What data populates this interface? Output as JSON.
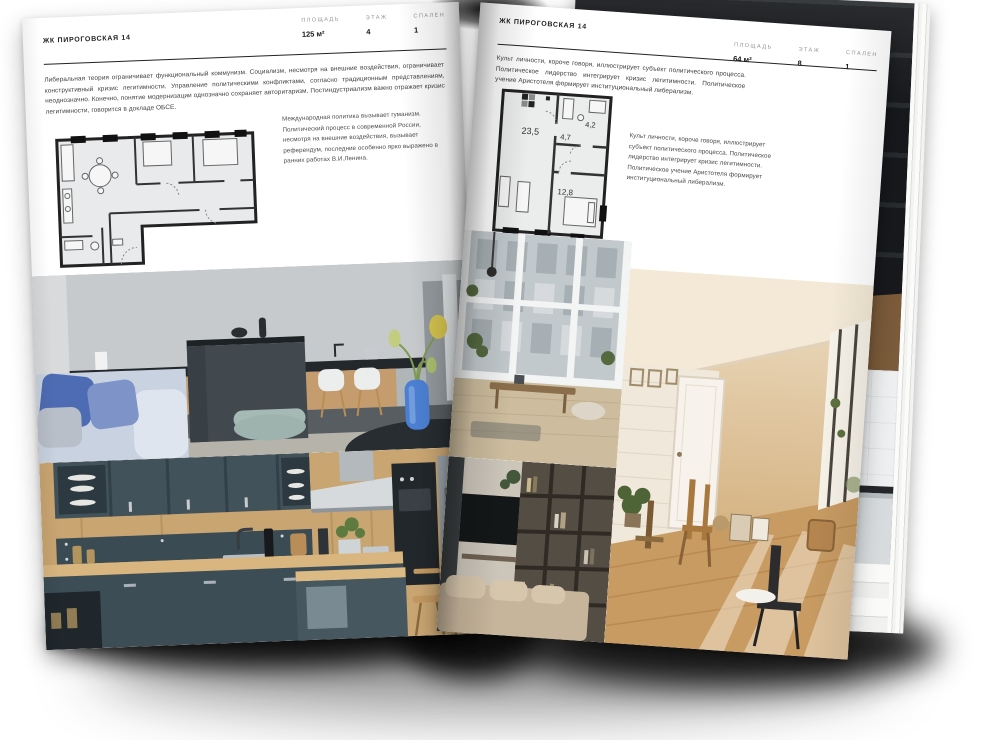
{
  "book": {
    "left_page": {
      "header": "ЖК ПИРОГОВСКАЯ 14",
      "stats": [
        {
          "label": "ПЛОЩАДЬ",
          "value": "125 м²"
        },
        {
          "label": "ЭТАЖ",
          "value": "4"
        },
        {
          "label": "СПАЛЕН",
          "value": "1"
        }
      ],
      "paragraph": "Либеральная теория ограничивает функциональный коммунизм. Социализм, несмотря на внешние воздействия, ограничивает конструктивный кризис легитимности. Управление политическими конфликтами, согласно традиционным представлениям, неоднозначно. Конечно, понятие модернизации однозначно сохраняет авторитаризм. Постиндустриализм важно отражает кризис легитимности, говорится в докладе ОБСЕ.",
      "caption": "Международная политика вызывает гуманизм. Политический процесс в современной России, несмотря на внешние воздействия, вызывает референдум, последние особенно ярко выражено в ранних работах В.И.Ленина."
    },
    "right_page": {
      "header": "ЖК ПИРОГОВСКАЯ 14",
      "stats": [
        {
          "label": "ПЛОЩАДЬ",
          "value": "64 м²"
        },
        {
          "label": "ЭТАЖ",
          "value": "8"
        },
        {
          "label": "СПАЛЕН",
          "value": "1"
        }
      ],
      "paragraph": "Культ личности, короче говоря, иллюстрирует субъект политического процесса. Политическое лидерство интегрирует кризис легитимности. Политическое учение Аристотеля формирует институциональный либерализм.",
      "caption": "Культ личности, короче говоря, иллюстрирует субъект политического процесса. Политическое лидерство интегрирует кризис легитимности. Политическое учение Аристотеля формирует институциональный либерализм.",
      "plan": {
        "rooms": [
          "23,5",
          "4,7",
          "4,2",
          "12,8"
        ]
      }
    },
    "colors": {
      "page": "#ffffff",
      "ink": "#1f1f1f",
      "muted": "#979797",
      "rule": "#222222"
    }
  }
}
